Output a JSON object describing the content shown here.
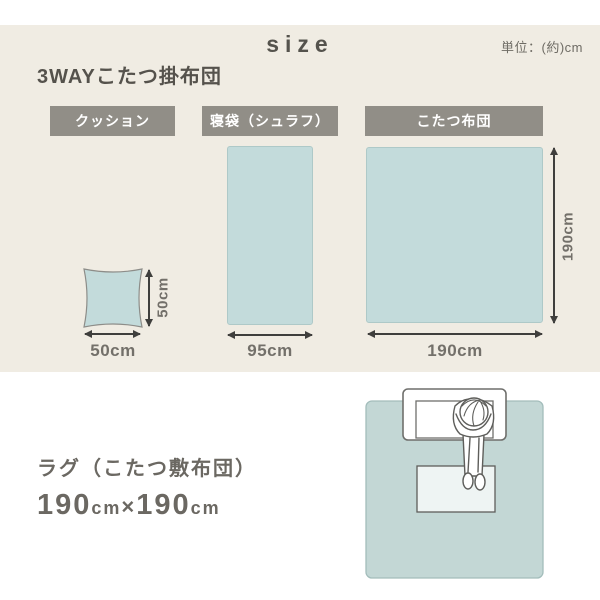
{
  "header": {
    "title": "size",
    "unit_note": "単位：(約)cm"
  },
  "top_section": {
    "heading": "3WAYこたつ掛布団",
    "items": [
      {
        "name": "cushion",
        "label": "クッション",
        "width_label": "50cm",
        "height_label": "50cm"
      },
      {
        "name": "sleeping-bag",
        "label": "寝袋（シュラフ）",
        "width_label": "95cm"
      },
      {
        "name": "kotatsu-futon",
        "label": "こたつ布団",
        "width_label": "190cm",
        "height_label": "190cm"
      }
    ]
  },
  "bottom_section": {
    "heading": "ラグ（こたつ敷布団）",
    "size_value": {
      "num1": "190",
      "unit1": "cm",
      "times": "×",
      "num2": "190",
      "unit2": "cm"
    }
  },
  "colors": {
    "panel_beige": "#f0ece3",
    "label_gray": "#918e87",
    "item_teal": "#c3dbdb",
    "rug_teal": "#c3d7d5",
    "table_light": "#eef4f3",
    "heading_text": "#55524c",
    "dim_text": "#73706a",
    "arrow": "#3f3f3d"
  }
}
